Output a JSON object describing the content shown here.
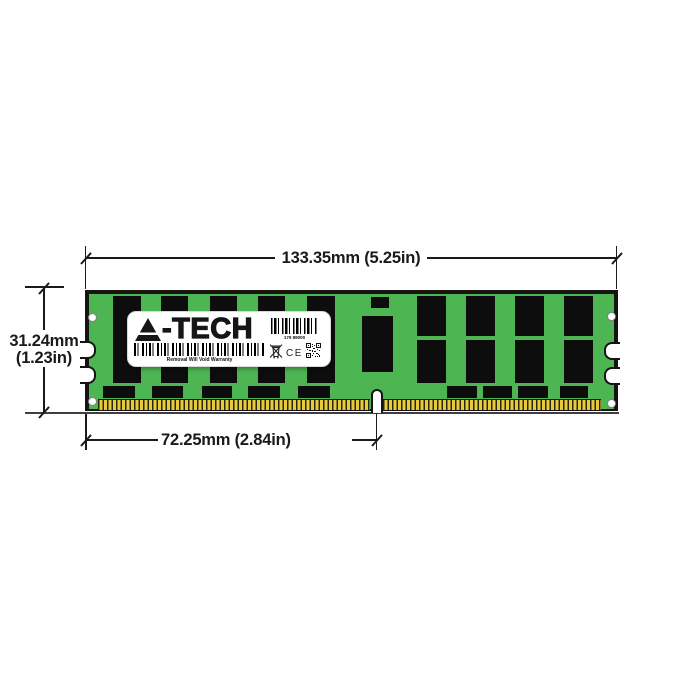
{
  "dimensions": {
    "width_label": "133.35mm (5.25in)",
    "height_label_mm": "31.24mm",
    "height_label_in": "(1.23in)",
    "notch_label": "72.25mm (2.84in)"
  },
  "label": {
    "logo_letter": "A",
    "logo_rest": "-TECH",
    "serial": "179 88000",
    "warranty": "Removal Will Void Warranty",
    "ce_mark": "CE"
  },
  "module": {
    "left_chip_columns": 5,
    "right_chip_pair_columns": 4,
    "bottom_small_components": 9,
    "edge_notches_per_side": 2,
    "mounting_holes": 4
  },
  "colors": {
    "pcb_green": "#4db551",
    "pin_gold": "#e8ca3d",
    "chip_black": "#0d0d0d",
    "line_ink": "#1a1a1a"
  }
}
